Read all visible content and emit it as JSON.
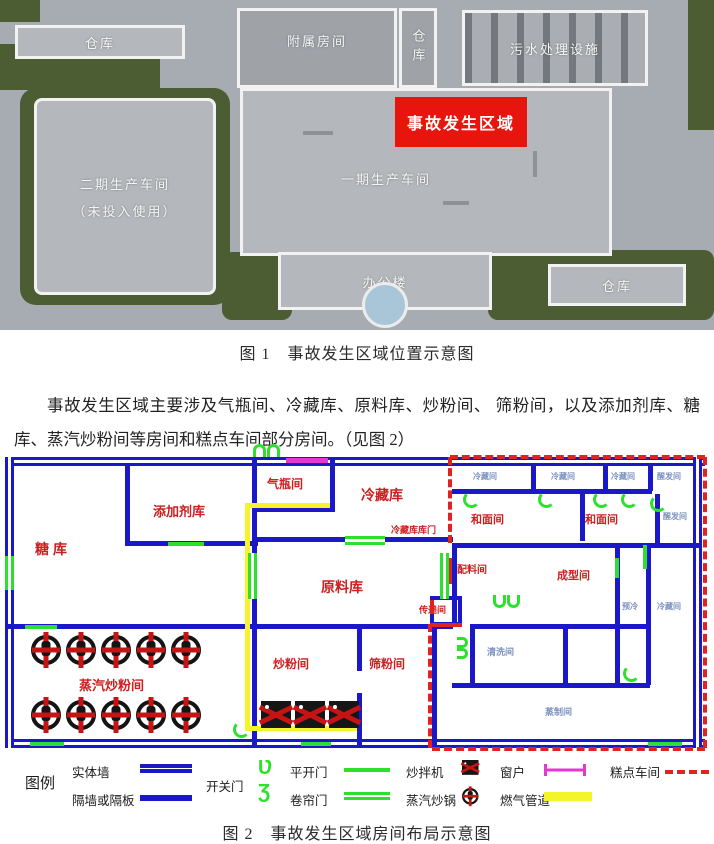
{
  "figure1": {
    "caption": "图 1　事故发生区域位置示意图",
    "buildings": {
      "warehouse_top_left": "仓库",
      "annex_rooms": "附属房间",
      "warehouse_top_small": "仓库",
      "sewage_treatment": "污水处理设施",
      "phase2_workshop_line1": "二期生产车间",
      "phase2_workshop_line2": "（未投入使用）",
      "phase1_workshop": "一期生产车间",
      "accident_area": "事故发生区域",
      "office_building": "办公楼",
      "warehouse_bottom_right": "仓库"
    }
  },
  "paragraph": "事故发生区域主要涉及气瓶间、冷藏库、原料库、炒粉间、 筛粉间，以及添加剂库、糖库、蒸汽炒粉间等房间和糕点车间部分房间。（见图 2）",
  "figure2": {
    "caption": "图 2　事故发生区域房间布局示意图",
    "rooms": {
      "sugar_store": "糖库",
      "additive_store": "添加剂库",
      "gas_cylinder_room": "气瓶间",
      "cold_storage": "冷藏库",
      "cold_storage_door": "冷藏库库门",
      "raw_material_store": "原料库",
      "dough_room_1": "和面间",
      "dough_room_2": "和面间",
      "batching_room": "配料间",
      "forming_room": "成型间",
      "transfer_room": "传递间",
      "steam_fry_room": "蒸汽炒粉间",
      "fry_room": "炒粉间",
      "sieve_room": "筛粉间",
      "cold_room_1": "冷藏间",
      "cold_room_2": "冷藏间",
      "cold_room_3": "冷藏间",
      "proofing_room_1": "醒发间",
      "proofing_room_2": "醒发间",
      "cleaning_room": "清洗间",
      "steaming_room": "蒸制间",
      "precooling_room": "预冷",
      "cold_room_4": "冷藏间"
    },
    "legend": {
      "title": "图例",
      "items": [
        {
          "label": "实体墙",
          "symbol": "blue-double-line"
        },
        {
          "label": "隔墙或隔板",
          "symbol": "blue-line"
        },
        {
          "label": "开关门",
          "symbol": "green-swing-door"
        },
        {
          "label": "平开门",
          "symbol": "green-line"
        },
        {
          "label": "卷帘门",
          "symbol": "green-double-line"
        },
        {
          "label": "炒拌机",
          "symbol": "mixer-icon"
        },
        {
          "label": "蒸汽炒锅",
          "symbol": "wok-icon"
        },
        {
          "label": "窗户",
          "symbol": "magenta-window"
        },
        {
          "label": "燃气管道",
          "symbol": "yellow-line"
        },
        {
          "label": "糕点车间",
          "symbol": "red-dashed-line"
        }
      ],
      "swing_glyphs": [
        "Ʋ",
        "Ʒ"
      ]
    },
    "colors": {
      "wall": "#1a18c8",
      "door": "#2ee02e",
      "gas_pipe": "#f4f42a",
      "window": "#e23ad0",
      "pastry_boundary": "#e02222",
      "room_label": "#cc1f1f",
      "minor_label": "#7d92c0",
      "accident_red": "#e8150e"
    }
  }
}
